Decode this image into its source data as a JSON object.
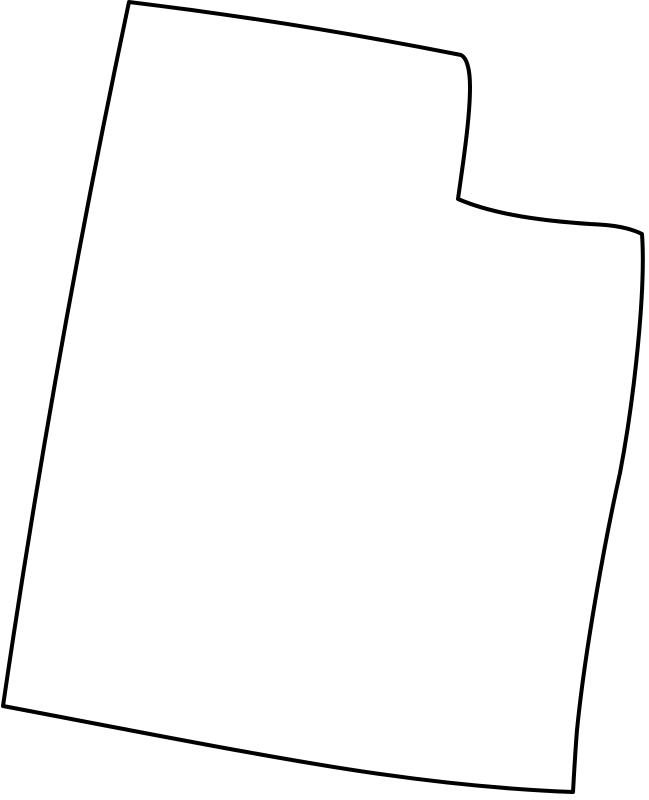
{
  "map": {
    "name": "utah-state-outline",
    "background_color": "#ffffff",
    "stroke_color": "#000000",
    "fill_color": "#ffffff",
    "stroke_width": "4",
    "viewbox": "0 0 649 800",
    "path": "M 129 2 Q 295 22 461 55 C 467 58 470 70 470 87 C 470 120 462 170 458 199 C 495 215 545 221 590 224 C 615 225 630 228 642 234 C 646 290 634 400 620 473 C 605 540 585 650 577 730 C 575 755 574 775 573 792 C 520 790 450 784 380 774 C 280 760 130 730 3 706 Q 55 350 129 2 Z"
  }
}
